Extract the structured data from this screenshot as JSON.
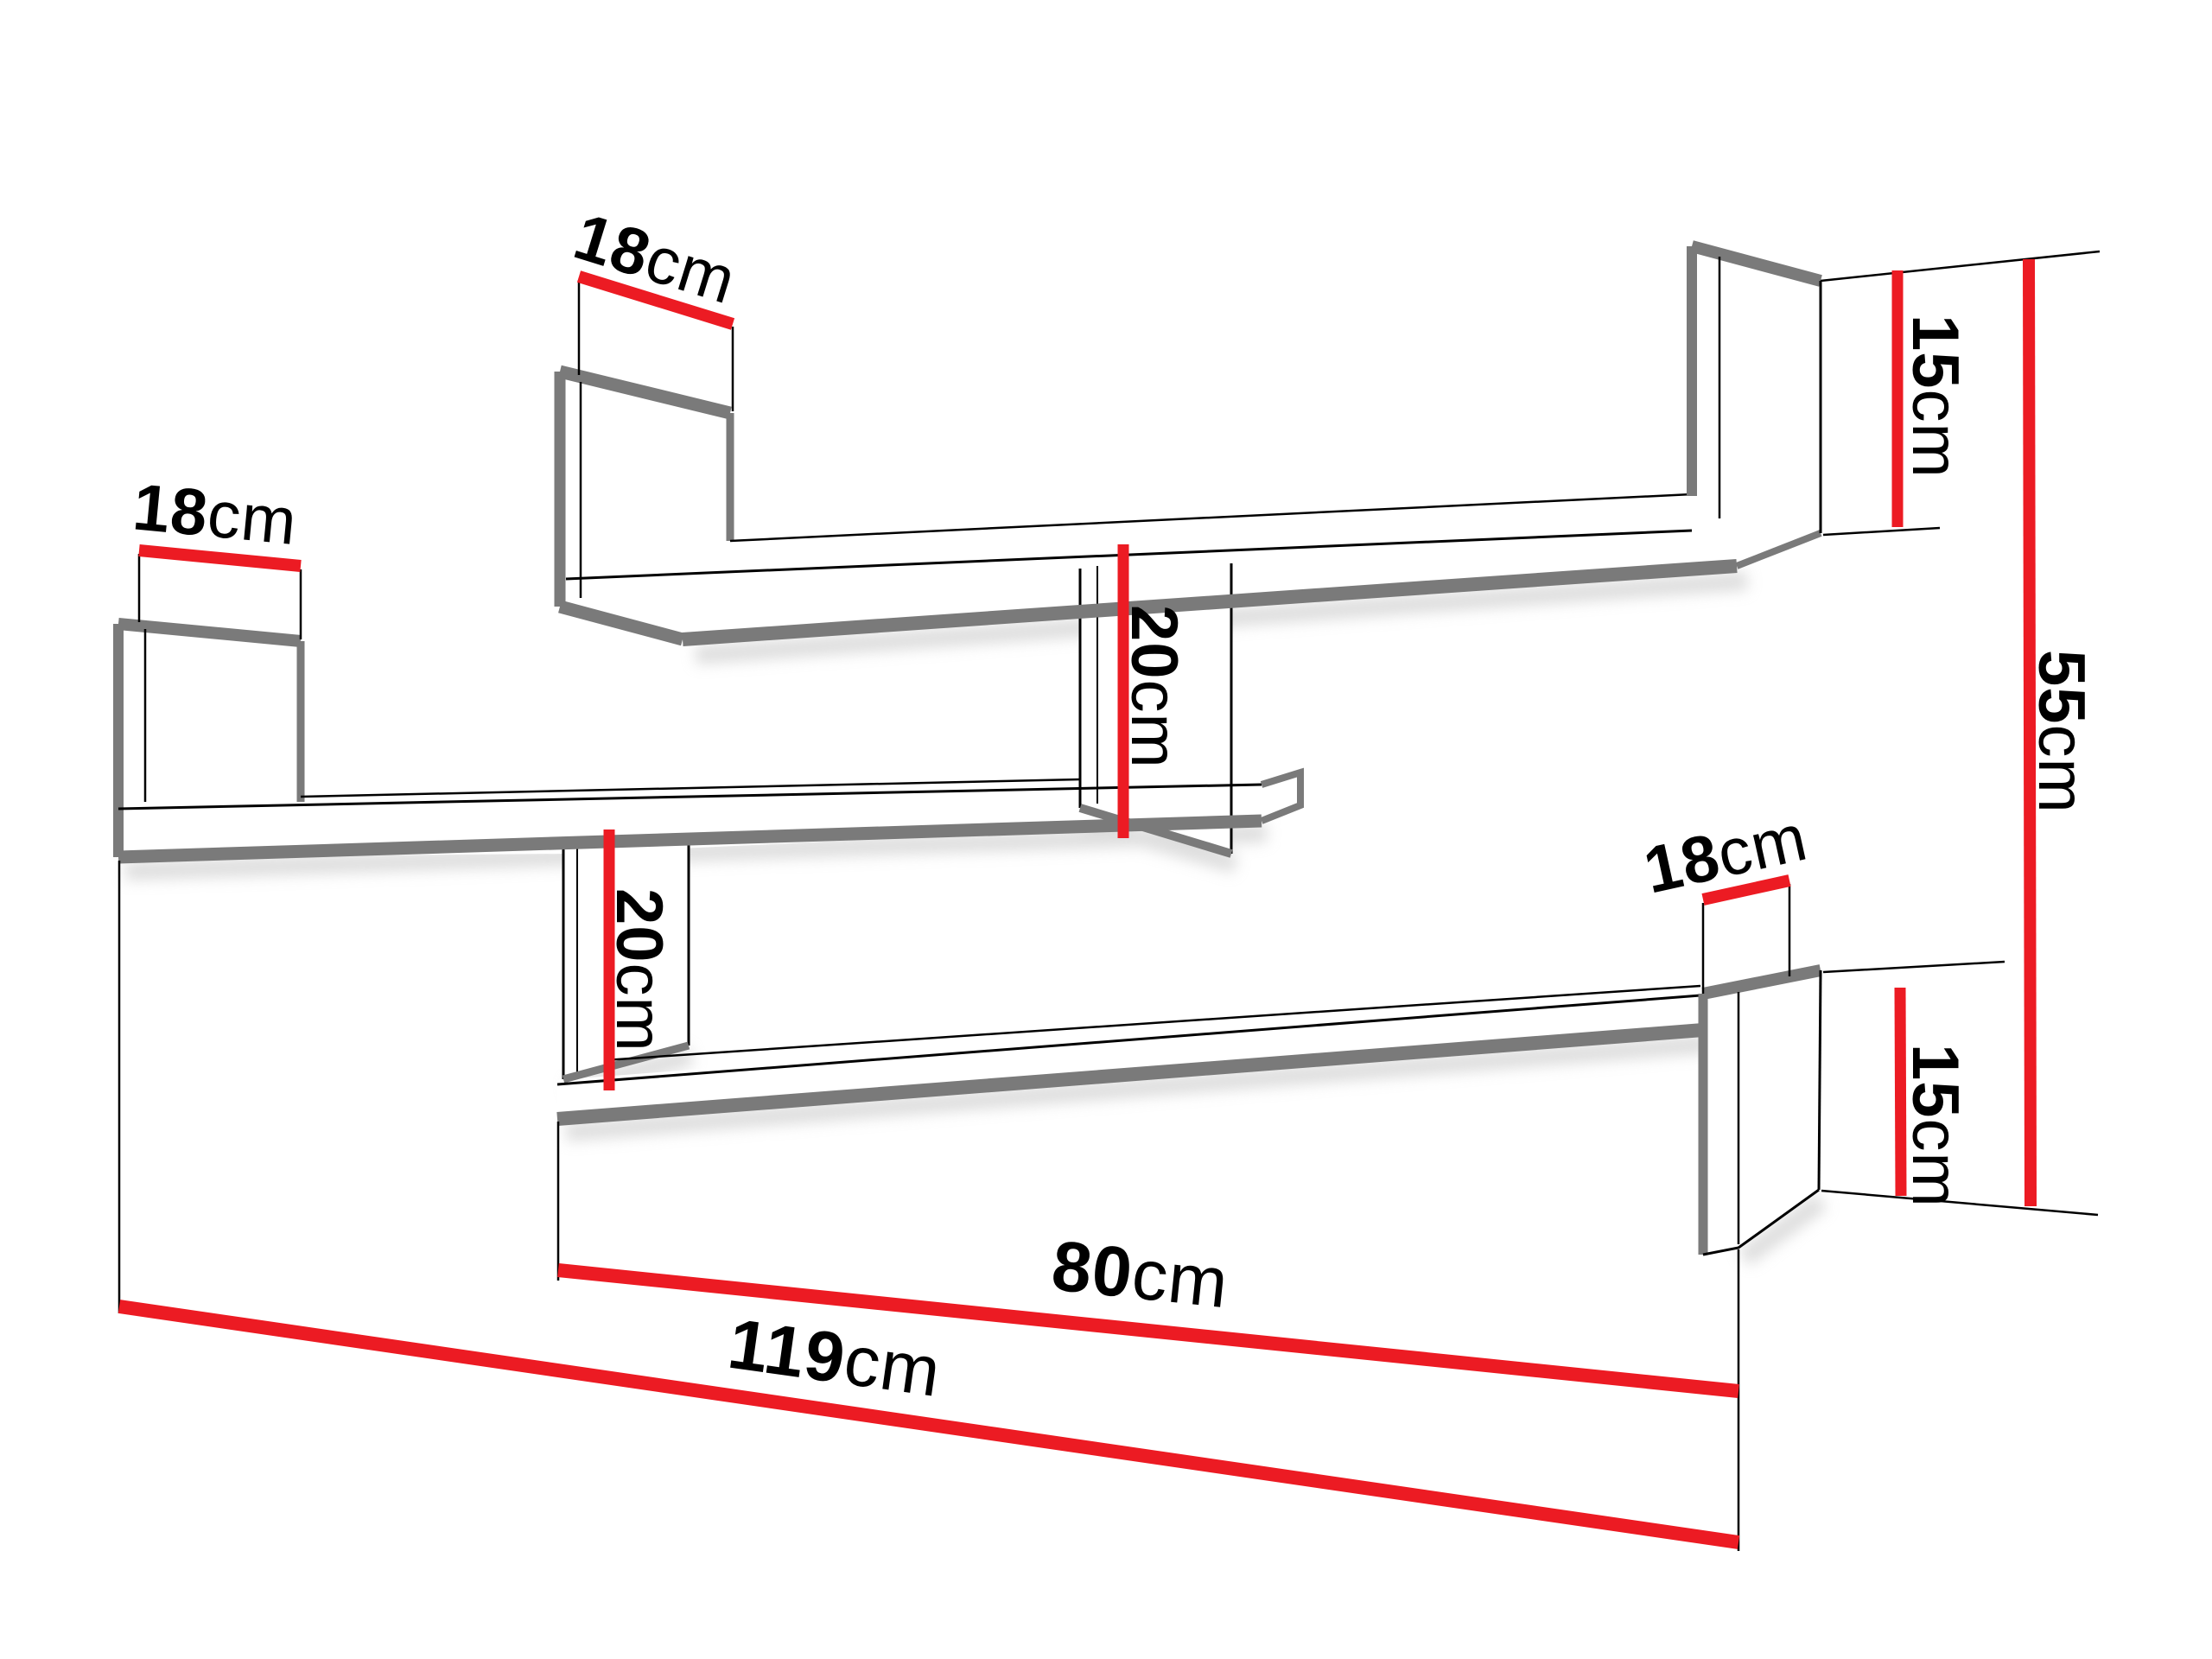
{
  "diagram": {
    "type": "furniture-dimension-drawing",
    "subject": "zigzag wall shelf unit with dimension callouts",
    "units": "cm",
    "colors": {
      "dimension_line": "#ec1b23",
      "panel_edge_gray": "#7a7a7a",
      "outline_black": "#000000",
      "shadow": "#c3c3c3",
      "background": "#ffffff",
      "label_text": "#000000"
    },
    "labels": {
      "top_left_depth": {
        "value": "18",
        "unit": "cm"
      },
      "middle_left_depth": {
        "value": "18",
        "unit": "cm"
      },
      "bottom_right_depth": {
        "value": "18",
        "unit": "cm"
      },
      "top_right_height": {
        "value": "15",
        "unit": "cm"
      },
      "bottom_right_height": {
        "value": "15",
        "unit": "cm"
      },
      "upper_divider_height": {
        "value": "20",
        "unit": "cm"
      },
      "lower_divider_height": {
        "value": "20",
        "unit": "cm"
      },
      "total_height": {
        "value": "55",
        "unit": "cm"
      },
      "bottom_shelf_width": {
        "value": "80",
        "unit": "cm"
      },
      "total_width": {
        "value": "119",
        "unit": "cm"
      }
    }
  }
}
